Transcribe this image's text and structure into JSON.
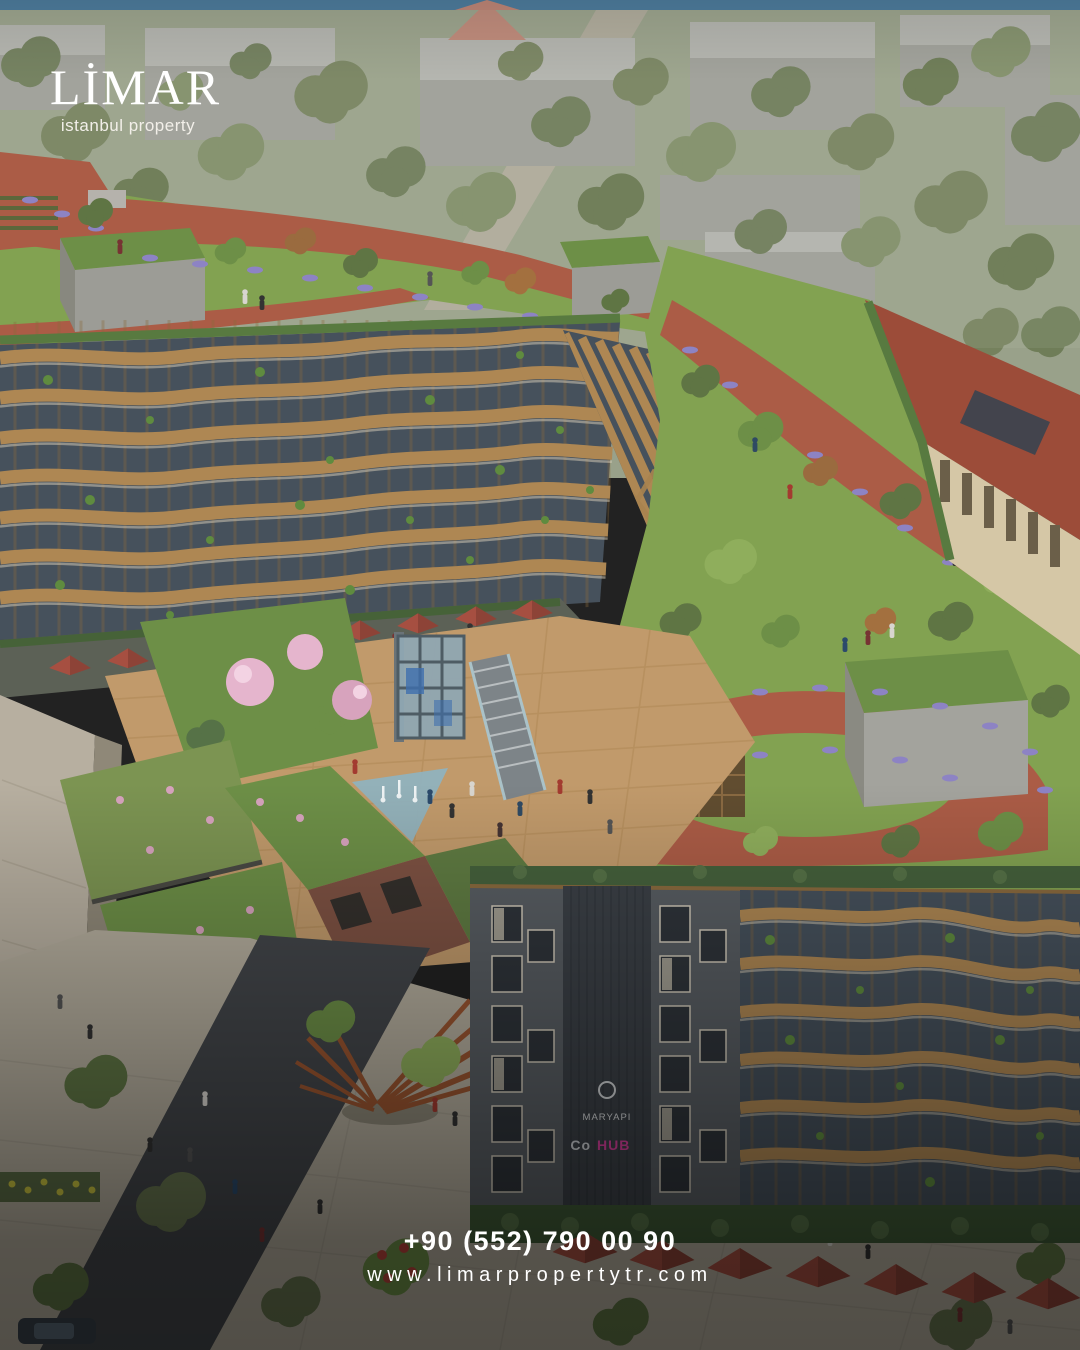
{
  "brand": {
    "name": "LİMAR",
    "tagline": "istanbul property"
  },
  "contact": {
    "phone": "+90 (552) 790 00 90",
    "website": "www.limarpropertytr.com"
  },
  "building_signage": {
    "developer": "MARYAPI",
    "project_prefix": "Co",
    "project_name": "HUB"
  },
  "colors": {
    "sky": "#4e7d9e",
    "city_base": "#99a18a",
    "city_building": "#9d9d98",
    "city_roof": "#b3b3ae",
    "tree_muted": "#75815d",
    "tree_dark": "#67754f",
    "tree_green": "#5f7544",
    "tree_bright": "#8fae5c",
    "lawn": "#82a251",
    "lawn_dark": "#6d8f47",
    "path_red": "#ab5c46",
    "lavender": "#8d83c4",
    "wood": "#ae8753",
    "wood_dark": "#8a6a3e",
    "glass": "#46515c",
    "facade_gray": "#585d62",
    "concrete": "#9e9e98",
    "beige_wall": "#d5c7a6",
    "roof_red": "#9c4c39",
    "deck": "#c19a6b",
    "water": "#8fb3c0",
    "umbrella": "#a64f41",
    "pavement": "#b4ad9d",
    "road": "#43464a",
    "stone": "#b7afa0",
    "blossom": "#e5b5cd",
    "rust": "#9a5530",
    "sign_band": "#3b4046",
    "sign_text": "#d8dadc",
    "project_accent": "#d43f9a",
    "text_white": "#ffffff"
  }
}
